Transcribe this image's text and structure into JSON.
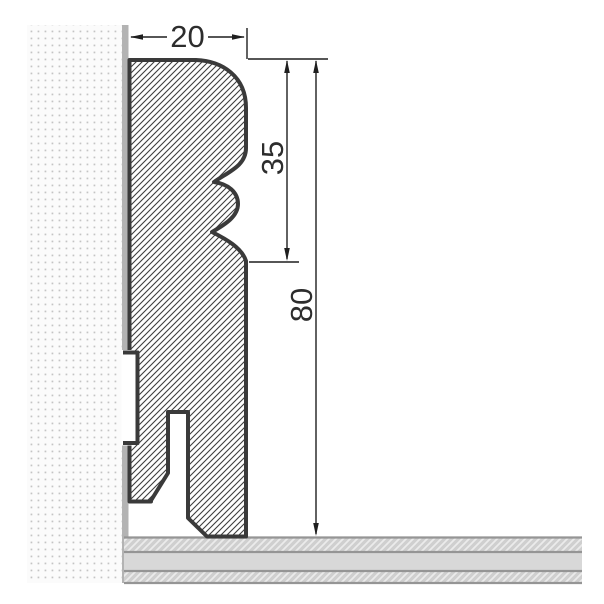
{
  "drawing": {
    "subject": "skirting-board-cross-section",
    "dimensions": {
      "width": {
        "value": "20",
        "orientation": "horizontal",
        "position": "top"
      },
      "upper_height": {
        "value": "35",
        "orientation": "vertical",
        "position": "right-inner"
      },
      "total_height": {
        "value": "80",
        "orientation": "vertical",
        "position": "right-outer"
      }
    },
    "wall": {
      "texture": "stippled-dots",
      "dot_color": "#c4c4c4",
      "surface_color": "#b3b3b3"
    },
    "floor": {
      "layer_count": 3,
      "base_color": "#d8d8d8",
      "border_color": "#959595",
      "hatch_light": "#ebebeb"
    },
    "profile": {
      "fill": "diagonal-hatch",
      "outline_color": "#3a3a3a",
      "hatch_color": "#3e3e3e"
    },
    "colors": {
      "background": "#ffffff",
      "dimension_lines": "#1f1f1f",
      "dimension_text": "#2d2d2d"
    }
  }
}
